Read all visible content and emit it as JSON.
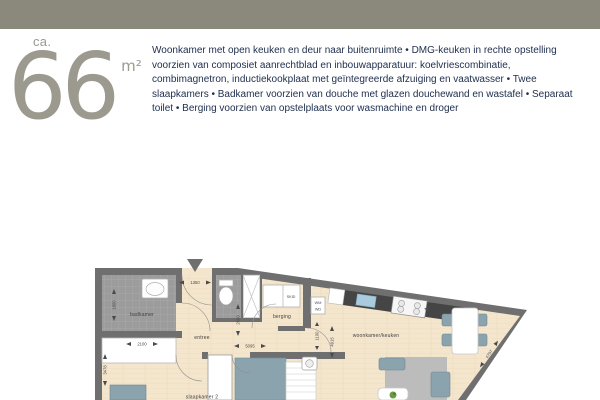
{
  "topbar": {
    "color": "#8a897b"
  },
  "area": {
    "prefix": "ca.",
    "value": "66",
    "unit": "m²"
  },
  "description": {
    "text": "Woonkamer met open keuken en deur naar buitenruimte • DMG-keuken in rechte opstelling voorzien van composiet aanrechtblad en inbouwapparatuur: koelvriescombinatie, combimagnetron, inductiekookplaat met geïntegreerde afzuiging en vaatwasser • Twee slaapkamers • Badkamer voorzien van douche met glazen douchewand en wastafel • Separaat toilet • Berging voorzien van opstelplaats voor wasmachine en droger"
  },
  "floorplan": {
    "labels": {
      "badkamer": "badkamer",
      "entree": "entree",
      "berging": "berging",
      "slaapkamer2": "slaapkamer 2",
      "woonkamer_keuken": "woonkamer/keuken",
      "skid": "SKID",
      "wm": "WM",
      "wd": "WD"
    },
    "dims": {
      "d1350": "1350",
      "d1800": "1800",
      "d2100": "2100",
      "d2600": "2600",
      "d3478": "3478",
      "d5095": "5095",
      "d1100": "1100",
      "d4915": "4915",
      "d6154": "6154",
      "d4707": "4707"
    },
    "colors": {
      "wall": "#6f6f6f",
      "floor": "#f4e5cd",
      "tile": "#9c9c9c",
      "furniture": "#8ba3ac",
      "counter": "#454545",
      "sink": "#a9cbdd",
      "rug": "#bcbcbc"
    }
  }
}
